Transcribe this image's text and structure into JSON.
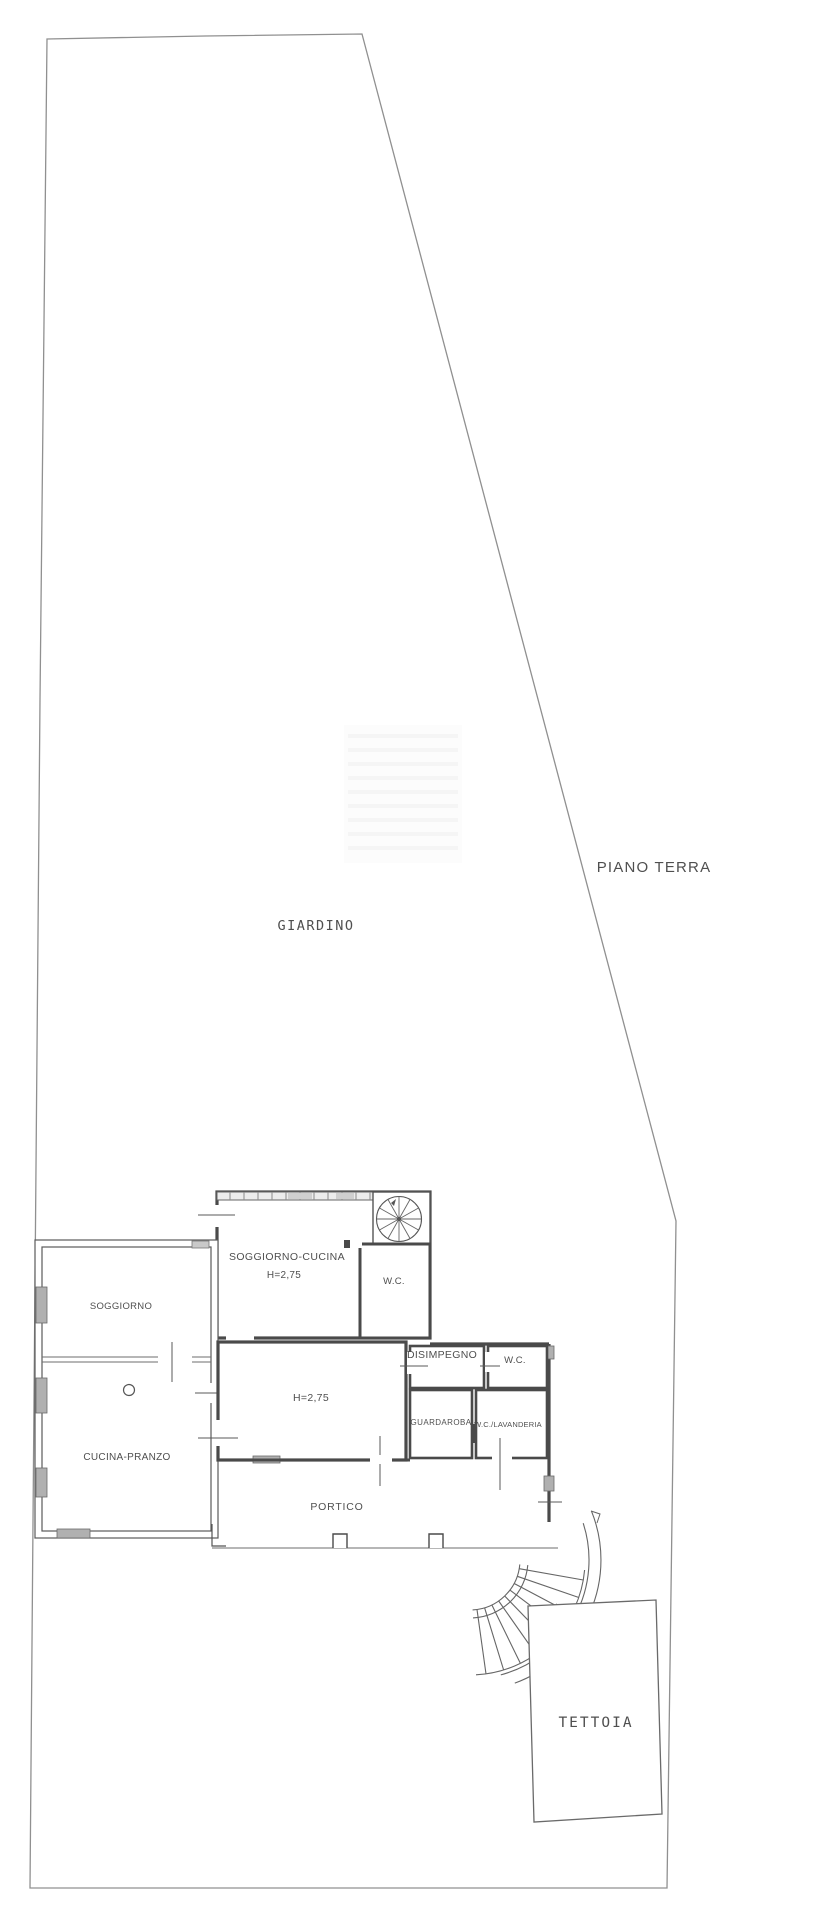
{
  "floor_plan": {
    "title": "PIANO TERRA",
    "garden_label": "GIARDINO",
    "canopy_label": "TETTOIA",
    "porch_label": "PORTICO",
    "rooms": {
      "soggiorno_cucina": "SOGGIORNO-CUCINA",
      "soggiorno_cucina_height": "H=2,75",
      "wc_upper": "W.C.",
      "soggiorno": "SOGGIORNO",
      "disimpegno": "DISIMPEGNO",
      "wc_hall": "W.C.",
      "central_height": "H=2,75",
      "guardaroba": "GUARDAROBA",
      "wc_lavanderia": "W.C./LAVANDERIA",
      "cucina_pranzo": "CUCINA-PRANZO"
    },
    "colors": {
      "boundary_line": "#909090",
      "wall": "#4a4a4a",
      "text": "#4f4f4f",
      "window_fill": "#b0b0b0",
      "background": "#ffffff"
    }
  }
}
